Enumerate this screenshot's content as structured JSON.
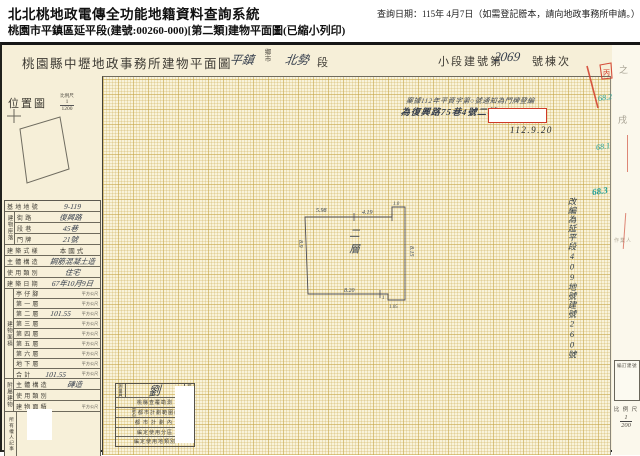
{
  "header": {
    "system_title": "北北桃地政電傳全功能地籍資料查詢系統",
    "document_title": "桃園市平鎮區延平段(建號:00260-000)[第二類]建物平面圖(已縮小列印)",
    "query_date": "查詢日期：115年 4月7日（如需登記謄本，請向地政事務所申請。）"
  },
  "sheet_title": {
    "office": "桃園縣中壢地政事務所建物平面圖",
    "township_value": "平鎮",
    "township_unit_top": "鄉",
    "township_unit_bottom": "市",
    "section_value": "北勢",
    "section_label": "段",
    "building_label": "小段建號第",
    "building_value": "2069",
    "building_suffix": "號棟次"
  },
  "location_map": {
    "label": "位置圖",
    "scale_label": "比例尺",
    "scale_num": "1",
    "scale_den": "1200"
  },
  "info_table": {
    "location_group_label": "建物座落",
    "rows": [
      {
        "label": "基地地號",
        "value": "9-119"
      },
      {
        "label": "街路",
        "value": "復興路"
      },
      {
        "label": "段巷",
        "value": "45巷"
      },
      {
        "label": "門牌",
        "value": "21號"
      },
      {
        "label": "建築式樣",
        "value": "本國式"
      },
      {
        "label": "主體構造",
        "value": "鋼筋混凝土造"
      },
      {
        "label": "使用類別",
        "value": "住宅"
      },
      {
        "label": "建築日期",
        "value": "67年10月9日"
      }
    ]
  },
  "area_table": {
    "group_label": "建物面積",
    "unit": "平方公尺",
    "rows": [
      {
        "label": "亭仔腳",
        "value": ""
      },
      {
        "label": "第一層",
        "value": ""
      },
      {
        "label": "第二層",
        "value": "101.55"
      },
      {
        "label": "第三層",
        "value": ""
      },
      {
        "label": "第四層",
        "value": ""
      },
      {
        "label": "第五層",
        "value": ""
      },
      {
        "label": "第六層",
        "value": ""
      },
      {
        "label": "地下層",
        "value": ""
      },
      {
        "label": "合計",
        "value": "101.55"
      }
    ]
  },
  "annex_table": {
    "group_label": "附屬建物",
    "rows": [
      {
        "label": "主體構造",
        "value": "磚造"
      },
      {
        "label": "使用類別",
        "value": ""
      },
      {
        "label": "建物面積",
        "value": "",
        "unit": "平方公尺"
      }
    ]
  },
  "owner_notes": {
    "label": "所有權人記事"
  },
  "note": {
    "line1": "案據112年平資字第○號通知為門牌登編",
    "line2": "為復興路75巷4號二樓",
    "date": "112.9.20"
  },
  "side_note": {
    "text": "改編為延平段409地號建號260號"
  },
  "teal_marks": {
    "m1": "68.2",
    "m2": "68.1",
    "m3": "68.3"
  },
  "plan": {
    "floor_label": "二層",
    "dim_top_left": "5.98",
    "dim_top_mid": "4.19",
    "dim_top_right": "1.0",
    "dim_left": "8.9",
    "dim_right": "8.15",
    "dim_bottom": "8.20",
    "dim_step_a": "1",
    "dim_step_b": "1.05"
  },
  "stamp_box": {
    "surveyor_label": "測量員",
    "signature": "劉",
    "checker_label": "檢查員",
    "row2": "桃縣查覆勘測",
    "row3_prefix": "是否",
    "row3_text": "都市計劃範圍內",
    "row4": "都市計劃內",
    "row5": "編定使用分區",
    "row6": "編定使用地類別"
  },
  "right_margin": {
    "faint_top": "之",
    "faint_mid": "戌",
    "faint_small": "作業人",
    "red_char": "丙",
    "box_label": "編訂建號",
    "scale_label": "比 例 尺",
    "scale_num": "1",
    "scale_den": "200"
  }
}
